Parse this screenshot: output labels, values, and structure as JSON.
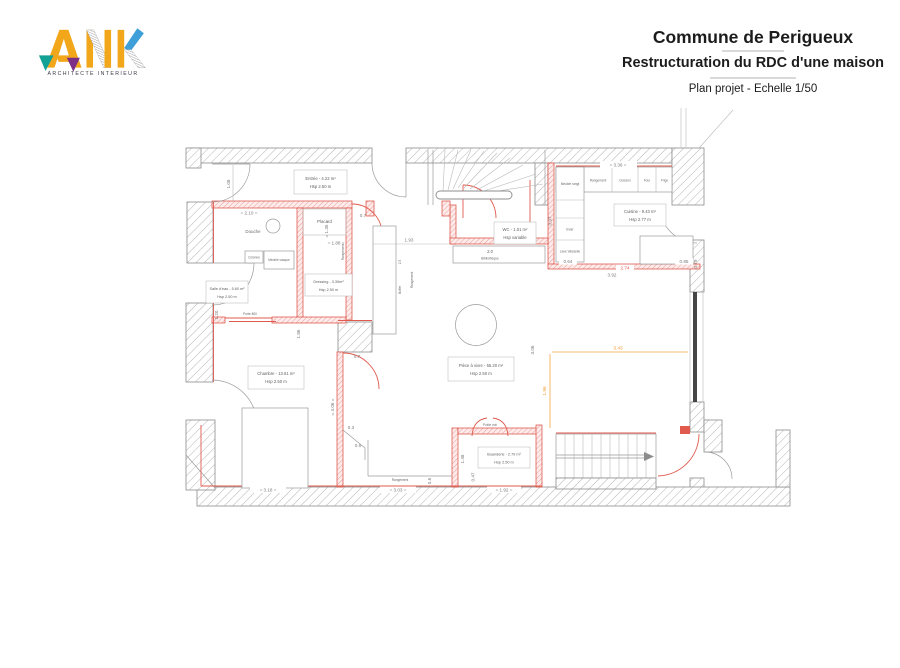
{
  "logo": {
    "brand": "ANK",
    "tagline": "ARCHITECTE INTERIEUR"
  },
  "title_block": {
    "title": "Commune de Perigueux",
    "subtitle": "Restructuration du RDC d'une maison",
    "caption": "Plan projet - Echelle 1/50"
  },
  "colors": {
    "new_wall_red": "#d9453a",
    "existing_wall_gray": "#8c8c8c",
    "dimension_orange": "#f29a2e",
    "logo_yellow": "#f2a71b",
    "logo_teal": "#12a195",
    "logo_purple": "#7d2e86",
    "logo_blue": "#3f9fd8"
  },
  "plan": {
    "rooms": {
      "entree": {
        "line1": "Entrée - 4.22 m²",
        "line2": "Hsp 2.50 m"
      },
      "salle_eau": {
        "line1": "Salle d'eau - 5.60 m²",
        "line2": "Hsp 2.50 m"
      },
      "dressing": {
        "line1": "Dressing - 3.39m²",
        "line2": "Hsp 2.50 m"
      },
      "chambre": {
        "line1": "Chambre - 13.61 m²",
        "line2": "Hsp 2.50 m"
      },
      "wc": {
        "line1": "WC - 1.01 m²",
        "line2": "Hsp variable"
      },
      "cuisine": {
        "line1": "Cuisine - 9.43 m²",
        "line2": "Hsp 2.77 m"
      },
      "piece_a_vivre": {
        "line1": "Pièce à vivre - 55.20 m²",
        "line2": "Hsp 2.50 m"
      },
      "buanderie": {
        "line1": "Buanderie - 2.79 m²",
        "line2": "Hsp 2.50 m"
      }
    },
    "labels": {
      "douche": "Douche",
      "placard": "Placard",
      "colonne": "Colonne",
      "meuble_vasque": "Meuble vasque",
      "rangement": "Rangement",
      "bibliotheque": "Bibliothèque",
      "buffet": "Buffet",
      "poele": "Poêle mix",
      "porte": "Porte 800",
      "kitchen_cabinets": [
        "Rangement",
        "Cuisson",
        "Four",
        "Frigo"
      ],
      "meuble_rangt": "Meuble rangt",
      "evier": "Evier",
      "lave_vaisselle": "Lave Vaisselle"
    },
    "dimensions": {
      "douche_w": "= 2.10 =",
      "entree_left_h": "1.08",
      "bath_inner": "= 1.35 =",
      "buffet_gap": "0.7",
      "dressing_w": "= 1.88 =",
      "dressing_h": "1.86",
      "hall_w": "1.93",
      "biblio_w": "2.0",
      "buffet_d": "2.5",
      "kitchen_w": "= 3.36 =",
      "kitchen_left_h": "0.97",
      "kitchen_d1": "0.64",
      "kitchen_d2": "3.92",
      "kitchen_d3": "0.85",
      "kitchen_red": "2.74",
      "pier_right": "0.79",
      "living_w_orange": "3.43",
      "living_h_orange": "1.96",
      "living_h": "3.06",
      "chambre_w": "= 3.18 =",
      "chambre_h": "= 4.06 =",
      "rangement_w": "= 3.03 =",
      "buanderie_w": "= 1.92 =",
      "rangement_h": "1.48",
      "buanderie_h": "0.47",
      "rangement_d": "0.6",
      "pier_bottom": "0.7",
      "notch_a": "0.3",
      "notch_b": "0.6",
      "left_pier": "1.20"
    }
  }
}
